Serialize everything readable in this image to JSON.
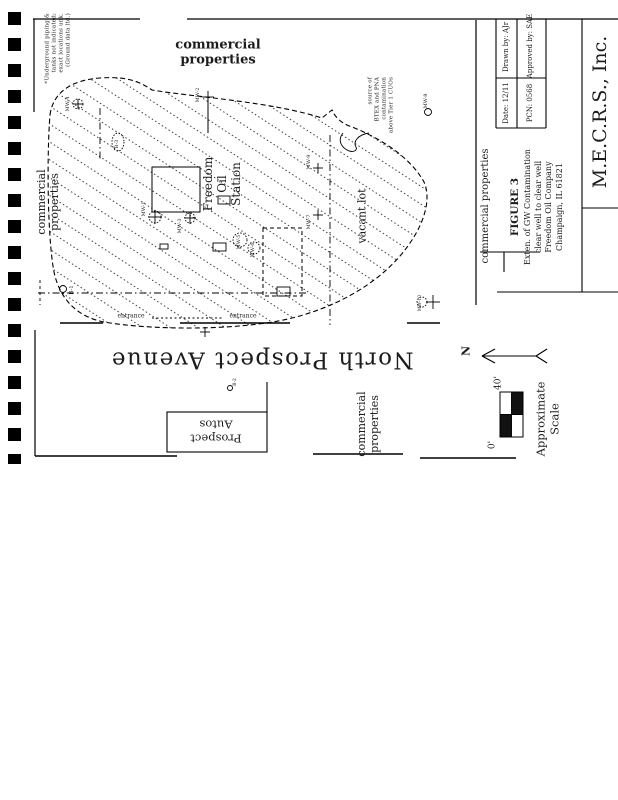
{
  "figure": {
    "note_top_left": "*Underground piping &\ntanks not indicated;\nexact locations unk.\n(Ground data ltd.)",
    "commercial_top": "commercial\nproperties",
    "commercial_left": "commercial\nproperties",
    "commercial_bottom": "commercial\nproperties",
    "commercial_titleblock": "commercial properties",
    "source_note": "source of\nBTEX and PNA contamination\nabove Tier 1 CUOs",
    "station_label": "Freedom\nOil\nStation",
    "vacant_lot": "vacant lot",
    "street_name": "North Prospect Avenue",
    "prospect_autos": "Prospect\nAutos",
    "entrance1": "entrance",
    "entrance2": "entrance"
  },
  "titleblock": {
    "company": "M.E.C.R.S., Inc.",
    "date": "Date: 12/11",
    "drawn_by": "Drawn by: AJr",
    "pcn": "PCN: 0568",
    "approved_by": "Approved by: SAE",
    "figure_no": "FIGURE 3",
    "caption_line1": "Exten. of GW Contamination",
    "caption_line2": "clear well to clear well",
    "caption_line3": "Freedom Oil Company",
    "caption_line4": "Champaign, IL 61821"
  },
  "north": {
    "label": "N"
  },
  "scale": {
    "zero": "0'",
    "forty": "40'",
    "label": "Approximate\nScale"
  },
  "map": {
    "wells": [
      {
        "label": "MW-4"
      },
      {
        "label": "MW-2"
      },
      {
        "label": "B-3"
      },
      {
        "label": "MW-1"
      },
      {
        "label": "MW-3"
      },
      {
        "label": "MW-5"
      },
      {
        "label": "MW-6"
      },
      {
        "label": "MW-9"
      },
      {
        "label": "MW-7"
      },
      {
        "label": "MW-8"
      },
      {
        "label": "MW-10"
      },
      {
        "label": "B-1"
      },
      {
        "label": "B-2"
      }
    ]
  },
  "colors": {
    "ink": "#1b1b1b",
    "paper": "#ffffff"
  }
}
